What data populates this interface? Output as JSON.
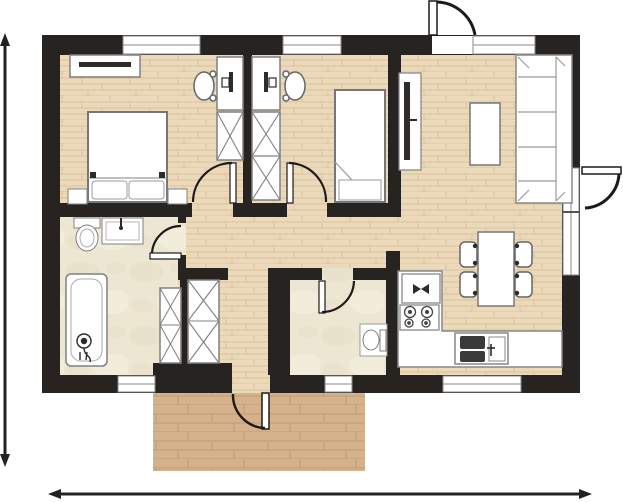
{
  "colors": {
    "background": "#ffffff",
    "wall": "#272321",
    "wood_floor": "#ecd9ba",
    "wood_line": "#d9c19d",
    "deck": "#d5b28b",
    "deck_line": "#bf9c74",
    "tile": "#ede6d2",
    "tile_accent": "#e3dcc4",
    "furniture_fill": "#ffffff",
    "furniture_stroke": "#808080",
    "detail_dark": "#2e2b28",
    "appliance_dark": "#3a3a3a",
    "door_arc": "#1d1b1a",
    "dimension": "#222222"
  },
  "plan": {
    "type": "floor-plan",
    "rooms": [
      {
        "name": "bedroom-1",
        "floor": "wood",
        "furniture": [
          "double-bed",
          "pillows",
          "nightstand-left",
          "nightstand-right",
          "tv-console",
          "desk",
          "desk-chair",
          "wardrobe-1-section"
        ]
      },
      {
        "name": "bedroom-2",
        "floor": "wood",
        "furniture": [
          "single-bed",
          "desk",
          "desk-chair",
          "wardrobe-2-sections"
        ]
      },
      {
        "name": "bathroom",
        "floor": "tile",
        "furniture": [
          "toilet",
          "washbasin",
          "bathtub",
          "shower-fixture",
          "wardrobe-2-sections"
        ]
      },
      {
        "name": "wc",
        "floor": "tile",
        "furniture": [
          "toilet"
        ]
      },
      {
        "name": "hallway",
        "floor": "wood",
        "furniture": [
          "wardrobe-2-sections"
        ]
      },
      {
        "name": "kitchen",
        "floor": "wood",
        "furniture": [
          "l-shaped-counter",
          "cooktop-4-burners",
          "double-sink",
          "appliance-box"
        ]
      },
      {
        "name": "dining-area",
        "floor": "wood",
        "furniture": [
          "dining-table",
          "chair",
          "chair",
          "chair",
          "chair"
        ]
      },
      {
        "name": "living-area",
        "floor": "wood",
        "furniture": [
          "sofa-3-seat",
          "coffee-table",
          "tv-panel"
        ]
      },
      {
        "name": "deck",
        "floor": "deck-wood",
        "furniture": []
      }
    ],
    "openings": {
      "windows_top_wall": 3,
      "windows_bottom_wall": 3,
      "window_door_right_wall": 1,
      "exterior_doors": [
        "entrance-top",
        "side-right",
        "deck-bottom"
      ],
      "interior_doors": [
        "bedroom-1",
        "bedroom-2",
        "bathroom",
        "wc"
      ]
    },
    "dimension_arrows": {
      "vertical": "left-edge-double-arrow",
      "horizontal": "bottom-edge-double-arrow",
      "labels_visible": false
    }
  }
}
